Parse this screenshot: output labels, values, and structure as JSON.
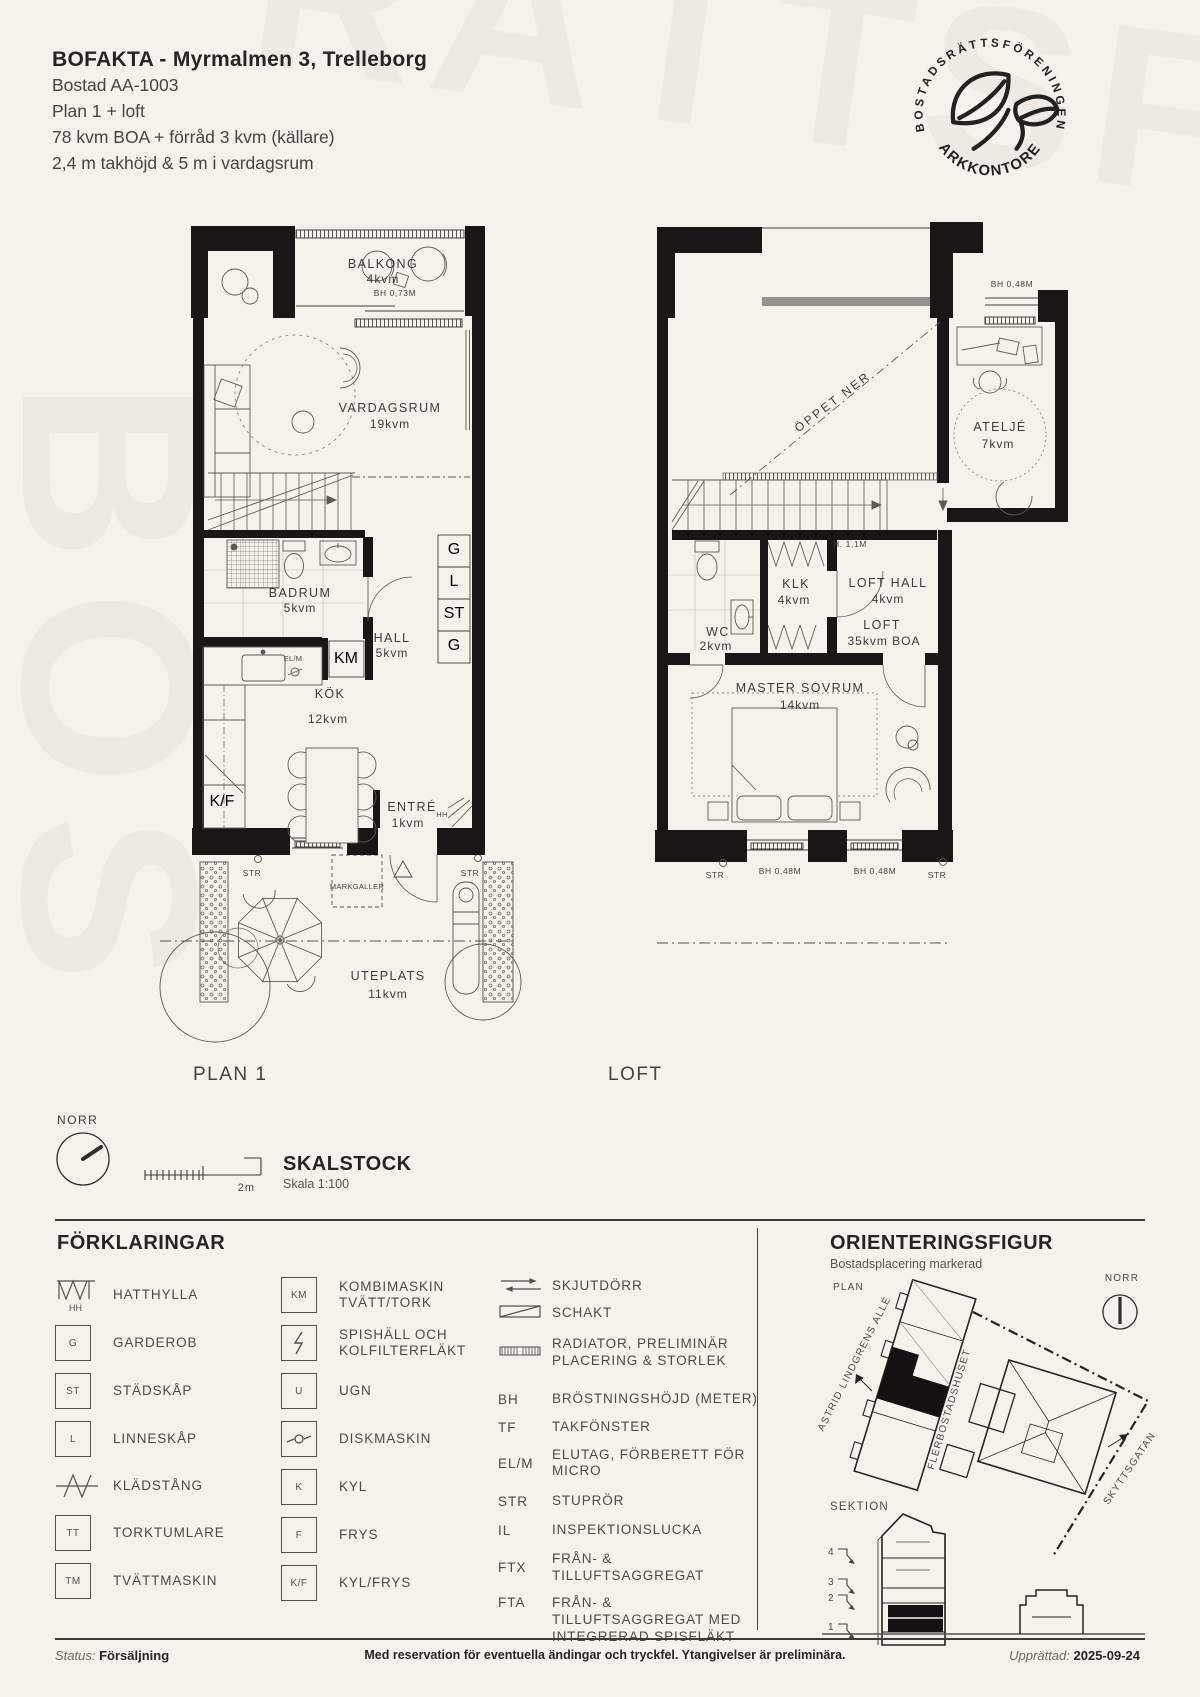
{
  "header": {
    "title": "BOFAKTA - Myrmalmen 3, Trelleborg",
    "address_line": "Bostad AA-1003",
    "plan_line": "Plan 1 + loft",
    "area_line": "78 kvm BOA + förråd 3 kvm (källare)",
    "height_line": "2,4 m takhöjd & 5 m i vardagsrum"
  },
  "logo": {
    "arc_top": "BOSTADSRÄTTSFÖRENINGEN",
    "arc_bottom": "•PARKKONTORET•"
  },
  "watermark": {
    "top": "RÄTTSF",
    "side": "BOS"
  },
  "plan1": {
    "label": "PLAN 1",
    "balkong": {
      "name": "BALKONG",
      "area": "4kvm",
      "bh": "BH 0,73M"
    },
    "vardagsrum": {
      "name": "VARDAGSRUM",
      "area": "19kvm"
    },
    "badrum": {
      "name": "BADRUM",
      "area": "5kvm"
    },
    "hall": {
      "name": "HALL",
      "area": "5kvm"
    },
    "kok": {
      "name": "KÖK",
      "area": "12kvm"
    },
    "entre": {
      "name": "ENTRÉ",
      "area": "1kvm"
    },
    "uteplats": {
      "name": "UTEPLATS",
      "area": "11kvm"
    },
    "closets": [
      "G",
      "L",
      "ST",
      "G"
    ],
    "km": "KM",
    "elm": "EL/M",
    "kf": "K/F",
    "hh": "HH",
    "markgaller": "MARKGALLER",
    "str": "STR"
  },
  "loft": {
    "label": "LOFT",
    "oppet_ner": "ÖPPET NER",
    "bh_top": "BH 0,48M",
    "atelje": {
      "name": "ATELJÉ",
      "area": "7kvm"
    },
    "stair_height": "H. 1,1M",
    "klk": {
      "name": "KLK",
      "area": "4kvm"
    },
    "loft_hall": {
      "name": "LOFT HALL",
      "area": "4kvm"
    },
    "wc": {
      "name": "WC",
      "area": "2kvm"
    },
    "loft_room": {
      "name": "LOFT",
      "area": "35kvm BOA"
    },
    "master": {
      "name": "MASTER SOVRUM",
      "area": "14kvm"
    },
    "bh_window_left": "BH 0,48M",
    "bh_window_right": "BH 0,48M",
    "str": "STR"
  },
  "tools": {
    "norr": "NORR",
    "scale_len": "2m",
    "skalstock": "SKALSTOCK",
    "skala": "Skala 1:100"
  },
  "legend": {
    "title": "FÖRKLARINGAR",
    "col1": [
      {
        "sym": "HH",
        "label": "HATTHYLLA"
      },
      {
        "sym": "G",
        "label": "GARDEROB"
      },
      {
        "sym": "ST",
        "label": "STÄDSKÅP"
      },
      {
        "sym": "L",
        "label": "LINNESKÅP"
      },
      {
        "sym": "",
        "label": "KLÄDSTÅNG"
      },
      {
        "sym": "TT",
        "label": "TORKTUMLARE"
      },
      {
        "sym": "TM",
        "label": "TVÄTTMASKIN"
      }
    ],
    "col2": [
      {
        "sym": "KM",
        "label": "KOMBIMASKIN TVÄTT/TORK"
      },
      {
        "sym": "",
        "label": "SPISHÄLL OCH KOLFILTERFLÄKT"
      },
      {
        "sym": "U",
        "label": "UGN"
      },
      {
        "sym": "",
        "label": "DISKMASKIN"
      },
      {
        "sym": "K",
        "label": "KYL"
      },
      {
        "sym": "F",
        "label": "FRYS"
      },
      {
        "sym": "K/F",
        "label": "KYL/FRYS"
      }
    ],
    "col3_symbols": [
      {
        "label": "SKJUTDÖRR"
      },
      {
        "label": "SCHAKT"
      },
      {
        "label": "RADIATOR, PRELIMINÄR PLACERING & STORLEK"
      }
    ],
    "col3_abbr": [
      {
        "abbr": "BH",
        "label": "BRÖSTNINGSHÖJD (METER)"
      },
      {
        "abbr": "TF",
        "label": "TAKFÖNSTER"
      },
      {
        "abbr": "EL/M",
        "label": "ELUTAG, FÖRBERETT FÖR MICRO"
      },
      {
        "abbr": "STR",
        "label": "STUPRÖR"
      },
      {
        "abbr": "IL",
        "label": "INSPEKTIONSLUCKA"
      },
      {
        "abbr": "FTX",
        "label": "FRÅN- & TILLUFTSAGGREGAT"
      },
      {
        "abbr": "FTA",
        "label": "FRÅN- & TILLUFTSAGGREGAT MED INTEGRERAD SPISFLÄKT"
      }
    ]
  },
  "orientering": {
    "title": "ORIENTERINGSFIGUR",
    "subtitle": "Bostadsplacering markerad",
    "plan_label": "PLAN",
    "norr": "NORR",
    "street_left": "ASTRID LINDGRENS ALLÉ",
    "building_label": "FLERBOSTADSHUSET",
    "street_right": "SKYTTSGATAN",
    "sektion_label": "SEKTION",
    "floors": [
      "4",
      "3",
      "2",
      "1"
    ]
  },
  "footer": {
    "status_label": "Status:",
    "status_value": "Försäljning",
    "disclaimer": "Med reservation för eventuella ändingar och tryckfel. Ytangivelser är preliminära.",
    "created_label": "Upprättad:",
    "created_value": "2025-09-24"
  },
  "colors": {
    "background": "#f5f1eb",
    "ink": "#23221f",
    "wall": "#181714"
  }
}
